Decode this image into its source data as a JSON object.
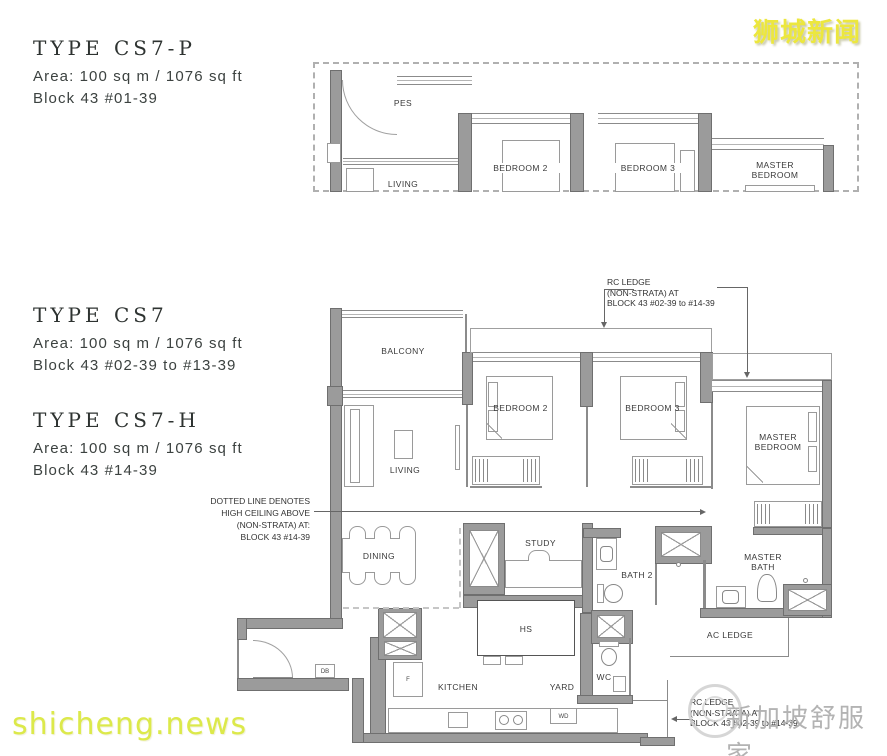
{
  "watermarks": {
    "top_right": "狮城新闻",
    "bottom_left": "shicheng.news",
    "bottom_right": "新加坡舒服家"
  },
  "unit_types": [
    {
      "title": "TYPE CS7-P",
      "area": "Area: 100 sq m / 1076 sq ft",
      "block": "Block 43 #01-39"
    },
    {
      "title": "TYPE CS7",
      "area": "Area: 100 sq m / 1076 sq ft",
      "block": "Block 43 #02-39 to #13-39"
    },
    {
      "title": "TYPE CS7-H",
      "area": "Area: 100 sq m / 1076 sq ft",
      "block": "Block 43 #14-39"
    }
  ],
  "upper_plan": {
    "labels": {
      "pes": "PES",
      "living": "LIVING",
      "bedroom2": "BEDROOM 2",
      "bedroom3": "BEDROOM 3",
      "master_line1": "MASTER",
      "master_line2": "BEDROOM"
    }
  },
  "main_plan": {
    "labels": {
      "balcony": "BALCONY",
      "living": "LIVING",
      "dining": "DINING",
      "bedroom2": "BEDROOM 2",
      "bedroom3": "BEDROOM 3",
      "master_line1": "MASTER",
      "master_line2": "BEDROOM",
      "study": "STUDY",
      "bath2": "BATH 2",
      "master_bath_line1": "MASTER",
      "master_bath_line2": "BATH",
      "kitchen": "KITCHEN",
      "yard": "YARD",
      "wc": "WC",
      "hs": "HS",
      "ac_ledge": "AC LEDGE",
      "db": "DB",
      "f": "F",
      "wd": "WD"
    },
    "notes": {
      "rc_ledge_top": [
        "RC LEDGE",
        "(NON-STRATA) AT",
        "BLOCK 43 #02-39 to #14-39"
      ],
      "high_ceiling": [
        "DOTTED LINE DENOTES",
        "HIGH CEILING ABOVE",
        "(NON-STRATA) AT:",
        "BLOCK 43 #14-39"
      ],
      "rc_ledge_bottom": [
        "RC LEDGE",
        "(NON-STRATA) AT",
        "BLOCK 43 #02-39 to #14-39"
      ]
    }
  },
  "colors": {
    "wall": "#9b9b9b",
    "watermark_yellow": "#ece73e",
    "watermark_gray": "#b3b3b3"
  }
}
